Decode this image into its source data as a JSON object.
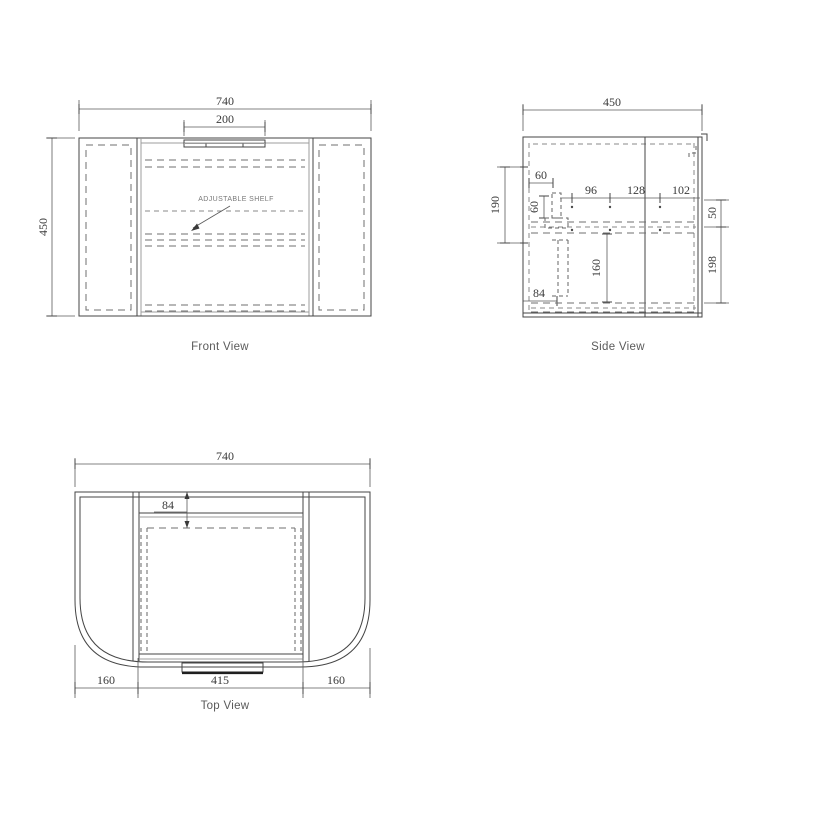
{
  "drawing": {
    "front": {
      "caption": "Front View",
      "shelf_label": "ADJUSTABLE SHELF",
      "dim_overall_width": "740",
      "dim_handle_width": "200",
      "dim_overall_height": "450"
    },
    "side": {
      "caption": "Side View",
      "dim_overall_depth": "450",
      "dim_rail_offset": "60",
      "dim_rail_size": "60",
      "dim_hole_a": "96",
      "dim_hole_b": "128",
      "dim_hole_c": "102",
      "dim_rail_span": "190",
      "dim_drawer_depth": "160",
      "dim_base_inset": "84",
      "dim_upper_gap": "50",
      "dim_lower_height": "198"
    },
    "top": {
      "caption": "Top View",
      "dim_overall_width": "740",
      "dim_front_band": "84",
      "dim_left_wing": "160",
      "dim_center": "415",
      "dim_right_wing": "160"
    },
    "colors": {
      "line": "#454545",
      "dashed": "#6f6f6f",
      "background": "#ffffff"
    }
  }
}
